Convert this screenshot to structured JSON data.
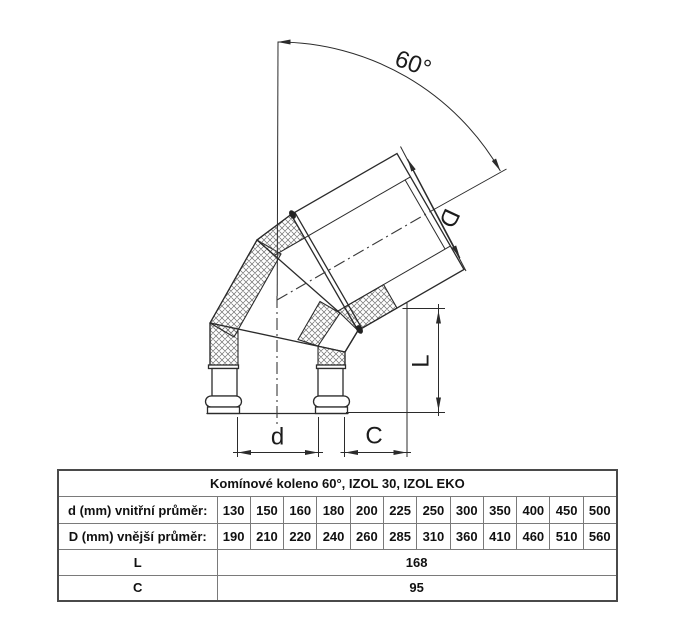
{
  "drawing": {
    "angle_label": "60°",
    "dim_outer_label": "D",
    "dim_length_label": "L",
    "dim_inner_label": "d",
    "dim_offset_label": "C",
    "line_color": "#2b2b2b"
  },
  "table": {
    "title": "Komínové koleno 60°, IZOL 30, IZOL EKO",
    "header_bg": "#d5d5d5",
    "label_bg": "#dcdcdc",
    "rows": [
      {
        "label": "d (mm) vnitřní průměr:",
        "values": [
          "130",
          "150",
          "160",
          "180",
          "200",
          "225",
          "250",
          "300",
          "350",
          "400",
          "450",
          "500"
        ]
      },
      {
        "label": "D (mm) vnější průměr:",
        "values": [
          "190",
          "210",
          "220",
          "240",
          "260",
          "285",
          "310",
          "360",
          "410",
          "460",
          "510",
          "560"
        ]
      },
      {
        "label": "L",
        "value": "168"
      },
      {
        "label": "C",
        "value": "95"
      }
    ]
  }
}
